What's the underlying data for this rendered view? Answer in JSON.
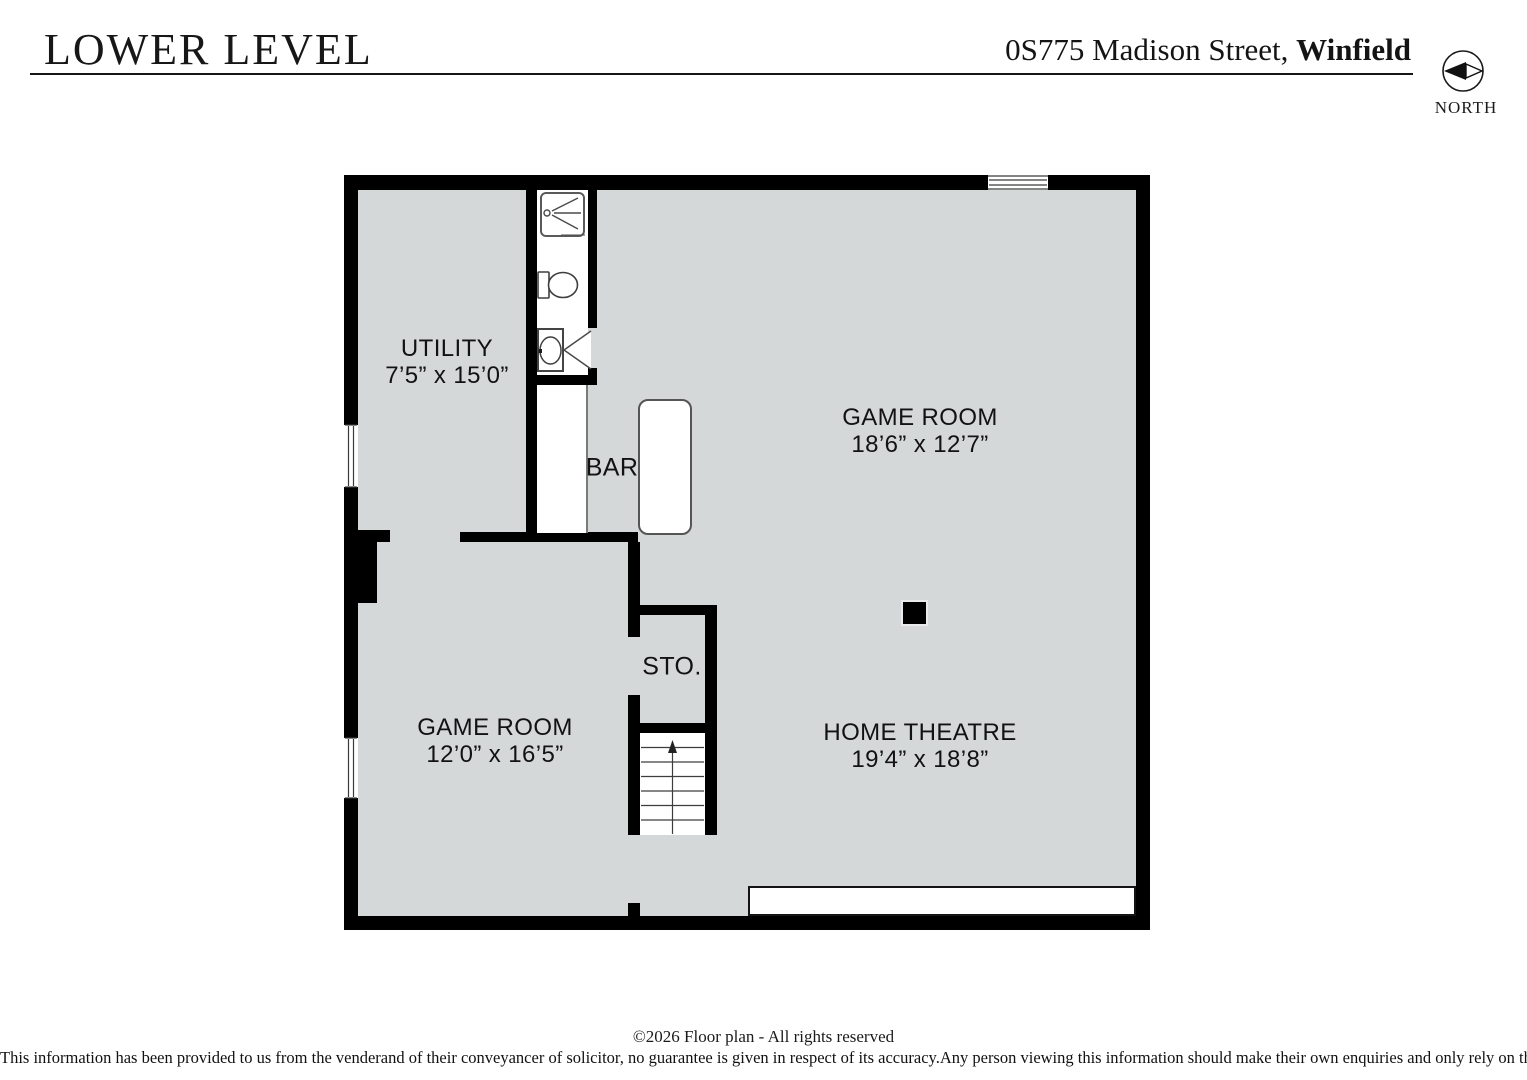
{
  "header": {
    "title": "LOWER LEVEL",
    "address": {
      "street": "0S775 Madison Street, ",
      "city": "Winfield"
    },
    "compass_label": "NORTH"
  },
  "labels": {
    "utility": {
      "name": "UTILITY",
      "dims": "7’5” x 15’0”"
    },
    "game_room_upper": {
      "name": "GAME ROOM",
      "dims": "18’6” x 12’7”"
    },
    "bar": {
      "name": "BAR"
    },
    "storage": {
      "name": "STO."
    },
    "game_room_lower": {
      "name": "GAME ROOM",
      "dims": "12’0” x 16’5”"
    },
    "home_theatre": {
      "name": "HOME THEATRE",
      "dims": "19’4” x 18’8”"
    }
  },
  "footer": {
    "copyright": "©2026  Floor plan  - All rights reserved",
    "disclaimer": "This information has been provided to us from the venderand of their conveyancer of solicitor, no guarantee is given in respect of its accuracy.Any person viewing this information should make their own enquiries and only rely on those enquiries."
  },
  "colors": {
    "floor": "#d5d8d9",
    "wall": "#000000",
    "fixture_line": "#4a4a4a"
  }
}
